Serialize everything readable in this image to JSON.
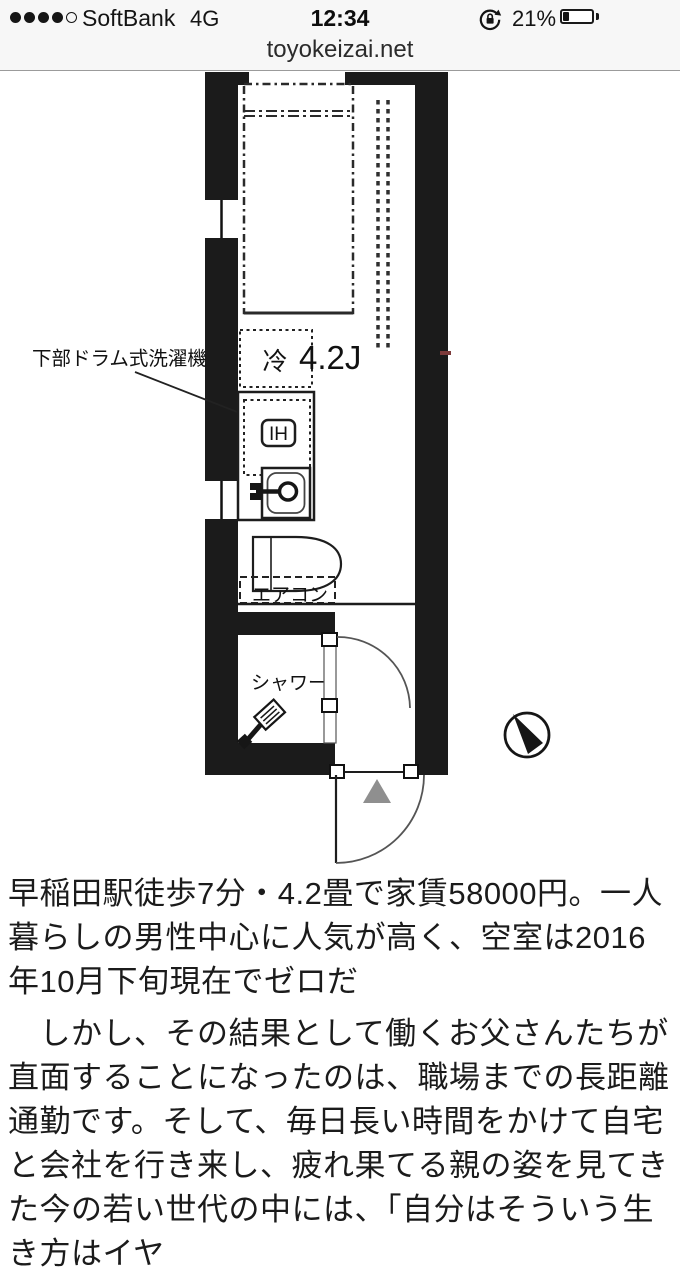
{
  "status_bar": {
    "carrier": "SoftBank",
    "network": "4G",
    "time": "12:34",
    "battery_percent": "21%",
    "signal_filled_dots": 4,
    "signal_total_dots": 5
  },
  "url_bar": {
    "domain": "toyokeizai.net"
  },
  "floorplan": {
    "labels": {
      "washer": "下部ドラム式洗濯機",
      "fridge": "冷",
      "room_size": "4.2J",
      "ih": "IH",
      "aircon": "エアコン",
      "shower": "シャワー"
    },
    "colors": {
      "wall": "#1b1b1b",
      "entry_triangle": "#8f8f8f",
      "red_mark": "#7d3b3b"
    }
  },
  "article": {
    "caption": "早稲田駅徒歩7分・4.2畳で家賃58000円。一人暮らしの男性中心に人気が高く、空室は2016年10月下旬現在でゼロだ",
    "body": "　しかし、その結果として働くお父さんたちが直面することになったのは、職場までの長距離通勤です。そして、毎日長い時間をかけて自宅と会社を行き来し、疲れ果てる親の姿を見てきた今の若い世代の中には、「自分はそういう生き方はイヤ"
  }
}
